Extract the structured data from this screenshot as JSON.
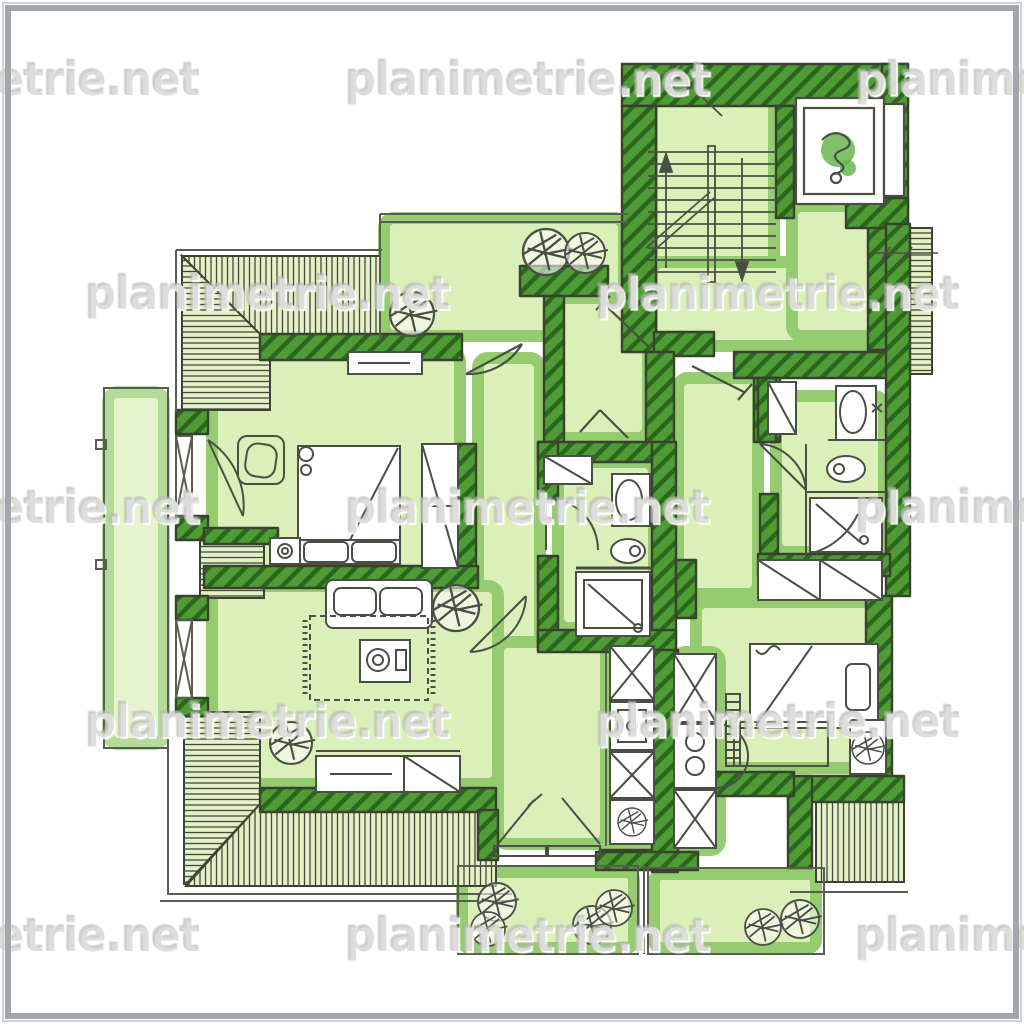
{
  "watermark": {
    "text": "planimetrie.net"
  },
  "palette": {
    "paper_white": "#ffffff",
    "frame_gray": "#a2a7ab",
    "wall_green": "#4f9c36",
    "wall_hatch_dark": "#2b661c",
    "wall_outline": "#39422f",
    "wash_light_green": "#d8eeb2",
    "wash_halo_green": "#8cc863",
    "roof_fill": "#e4f1c7",
    "roof_line": "#43483c",
    "sketch_ink": "#4a4f45",
    "watermark_gray": "#c3c3bf",
    "elevator_blob_green": "#5db344"
  },
  "diagram": {
    "type": "hand-drawn floor plan (attic storey, green marker rendering)",
    "elements": [
      "stairwell-with-two-flights",
      "elevator",
      "entry-landing",
      "top-terrace-with-plants",
      "side-balcony",
      "two-bottom-balconies-with-plants",
      "left-apartment-bedroom-with-double-bed",
      "wardrobes",
      "armchair",
      "living-room-with-sofa-rug-coffee-table",
      "sideboards",
      "central-bathroom-with-basin-toilet-shower",
      "right-bathroom-with-basin-toilet-shower",
      "right-bedroom-with-bed-desk-radiator",
      "two-kitchenettes-with-sink-and-stove",
      "sloped-roof-hatching",
      "potted-plants",
      "door-swings",
      "dimension-ticks"
    ]
  }
}
